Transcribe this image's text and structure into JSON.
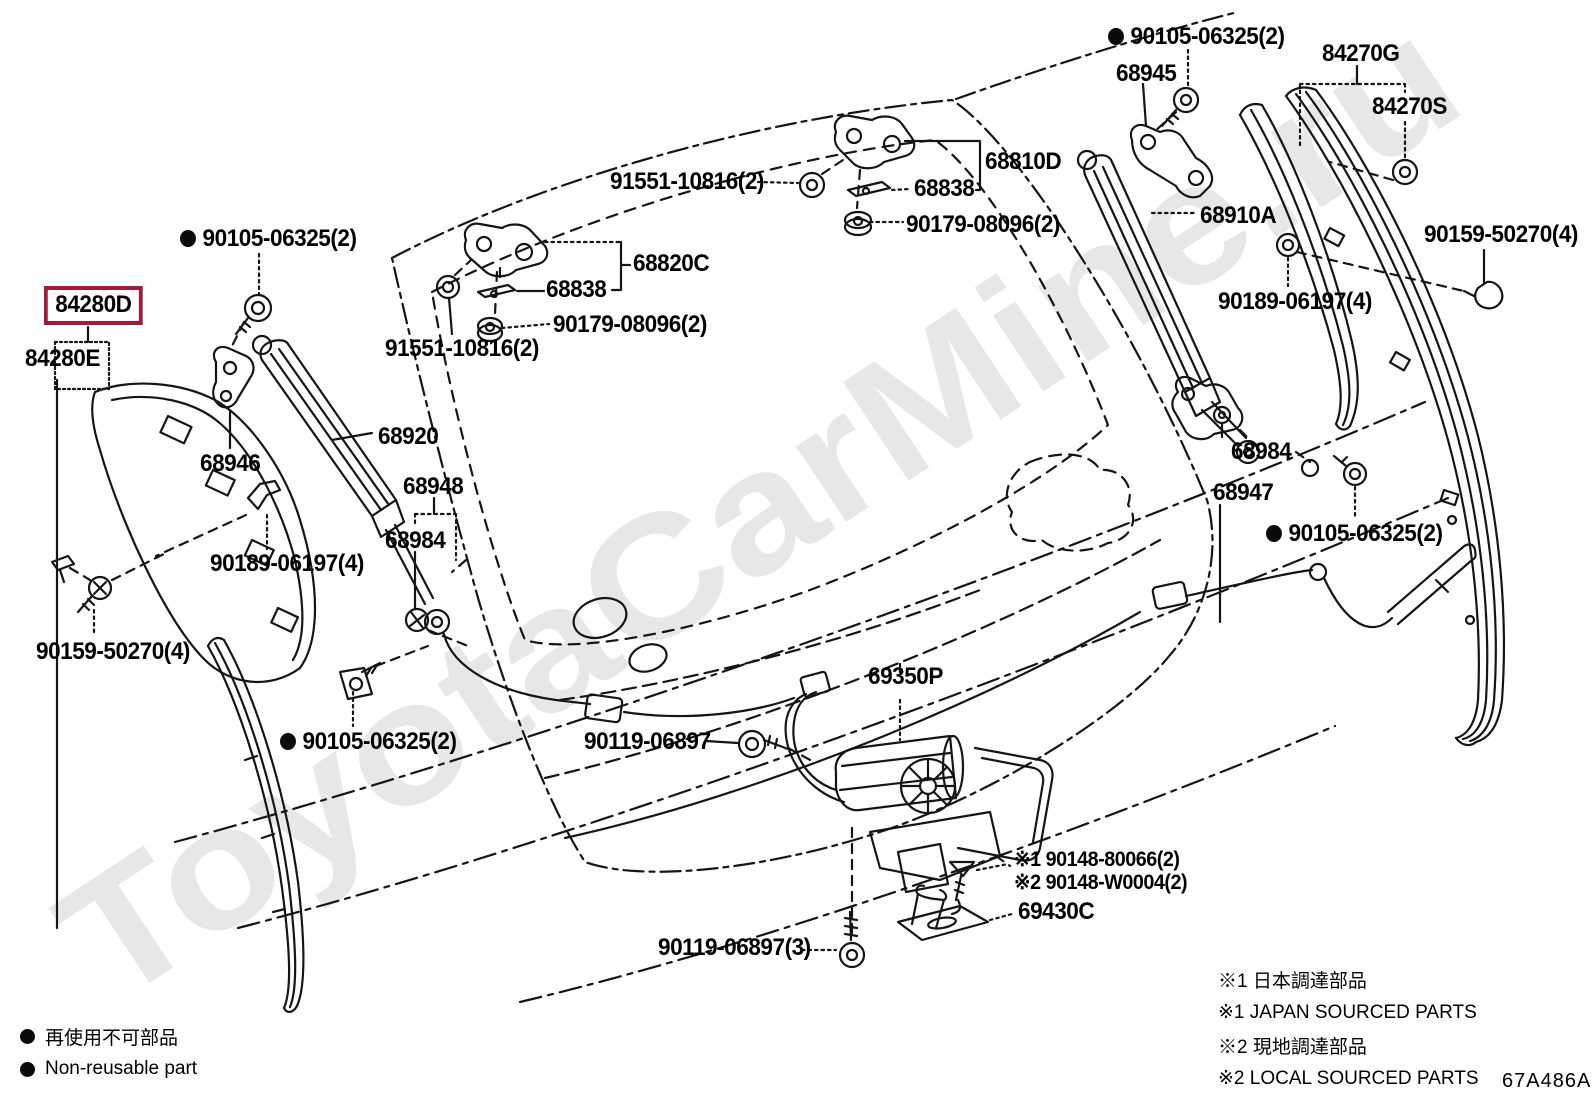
{
  "watermark": "ToyotaCarMine.ru",
  "doc_code": "67A486A",
  "highlight_color": "#a11a38",
  "legend_left": {
    "jp": "再使用不可部品",
    "en": "Non-reusable part"
  },
  "legend_right": {
    "rows": [
      "※1 日本調達部品",
      "※1 JAPAN SOURCED PARTS",
      "※2 現地調達部品",
      "※2 LOCAL SOURCED PARTS"
    ]
  },
  "labels": [
    {
      "id": "90105-06325-2-left",
      "text": "90105-06325(2)",
      "x": 180,
      "y": 226,
      "bullet": true
    },
    {
      "id": "84280d",
      "text": "84280D",
      "x": 44,
      "y": 286,
      "boxed": true
    },
    {
      "id": "84280e",
      "text": "84280E",
      "x": 25,
      "y": 346
    },
    {
      "id": "68946",
      "text": "68946",
      "x": 200,
      "y": 451
    },
    {
      "id": "68920",
      "text": "68920",
      "x": 378,
      "y": 424
    },
    {
      "id": "68948",
      "text": "68948",
      "x": 403,
      "y": 474
    },
    {
      "id": "68984-left",
      "text": "68984",
      "x": 385,
      "y": 528
    },
    {
      "id": "90189-06197-4-left",
      "text": "90189-06197(4)",
      "x": 210,
      "y": 551
    },
    {
      "id": "90159-50270-4-left",
      "text": "90159-50270(4)",
      "x": 36,
      "y": 639
    },
    {
      "id": "90105-06325-2-bottomleft",
      "text": "90105-06325(2)",
      "x": 280,
      "y": 729,
      "bullet": true
    },
    {
      "id": "91551-10816-2-top",
      "text": "91551-10816(2)",
      "x": 610,
      "y": 169
    },
    {
      "id": "68838-top",
      "text": "68838",
      "x": 914,
      "y": 176
    },
    {
      "id": "68810d",
      "text": "68810D",
      "x": 985,
      "y": 149
    },
    {
      "id": "90179-08096-2-top",
      "text": "90179-08096(2)",
      "x": 906,
      "y": 212
    },
    {
      "id": "68820c",
      "text": "68820C",
      "x": 633,
      "y": 251
    },
    {
      "id": "68838-mid",
      "text": "68838",
      "x": 546,
      "y": 277
    },
    {
      "id": "90179-08096-2-mid",
      "text": "90179-08096(2)",
      "x": 553,
      "y": 312
    },
    {
      "id": "91551-10816-2-mid",
      "text": "91551-10816(2)",
      "x": 385,
      "y": 336
    },
    {
      "id": "90105-06325-2-topright",
      "text": "90105-06325(2)",
      "x": 1108,
      "y": 24,
      "bullet": true
    },
    {
      "id": "68945",
      "text": "68945",
      "x": 1116,
      "y": 61
    },
    {
      "id": "84270g",
      "text": "84270G",
      "x": 1322,
      "y": 41
    },
    {
      "id": "84270s",
      "text": "84270S",
      "x": 1372,
      "y": 94
    },
    {
      "id": "68910a",
      "text": "68910A",
      "x": 1200,
      "y": 203
    },
    {
      "id": "90159-50270-4-right",
      "text": "90159-50270(4)",
      "x": 1424,
      "y": 222
    },
    {
      "id": "90189-06197-4-right",
      "text": "90189-06197(4)",
      "x": 1218,
      "y": 289
    },
    {
      "id": "68984-right",
      "text": "68984",
      "x": 1231,
      "y": 439
    },
    {
      "id": "68947",
      "text": "68947",
      "x": 1213,
      "y": 480
    },
    {
      "id": "90105-06325-2-right",
      "text": "90105-06325(2)",
      "x": 1266,
      "y": 521,
      "bullet": true
    },
    {
      "id": "69350p",
      "text": "69350P",
      "x": 868,
      "y": 664
    },
    {
      "id": "90119-06897",
      "text": "90119-06897",
      "x": 584,
      "y": 729
    },
    {
      "id": "90148-80066",
      "text": "※1 90148-80066(2)",
      "x": 1014,
      "y": 849,
      "small": true
    },
    {
      "id": "90148-w0004",
      "text": "※2 90148-W0004(2)",
      "x": 1014,
      "y": 872,
      "small": true
    },
    {
      "id": "69430c",
      "text": "69430C",
      "x": 1018,
      "y": 899
    },
    {
      "id": "90119-06897-3",
      "text": "90119-06897(3)",
      "x": 658,
      "y": 935
    }
  ]
}
